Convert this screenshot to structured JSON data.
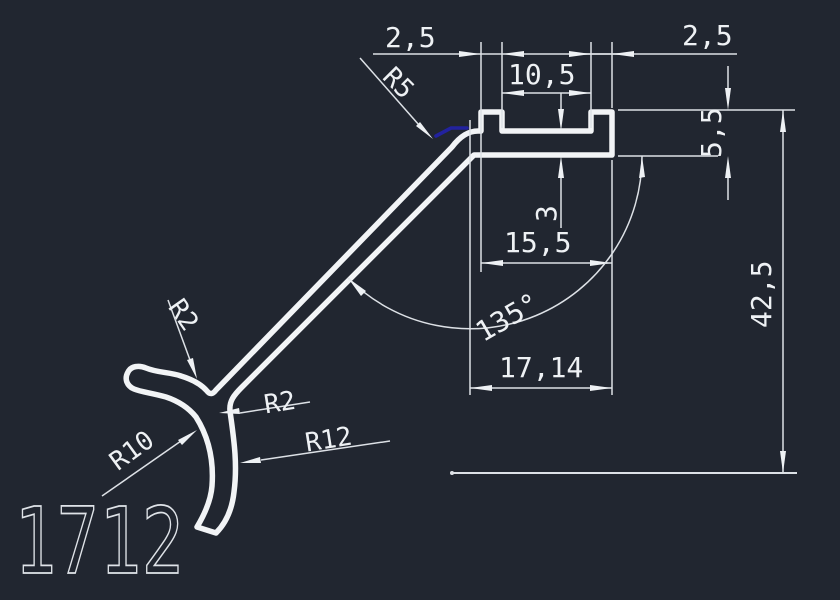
{
  "drawing": {
    "title": "aluminium-profile-cross-section",
    "part_number": "1712",
    "colors": {
      "background": "#212630",
      "lines": "#eef1f4",
      "selection_highlight": "#22229e"
    },
    "dims": {
      "lip_left": "2,5",
      "groove_width": "10,5",
      "lip_right": "2,5",
      "rail_thickness": "5,5",
      "web_thickness": "3",
      "groove_outer_width": "15,5",
      "bend_angle": "135°",
      "horizontal_offset": "17,14",
      "overall_height": "42,5"
    },
    "radii": {
      "r5": "R5",
      "r2_upper": "R2",
      "r2_lower": "R2",
      "r10": "R10",
      "r12": "R12"
    }
  }
}
